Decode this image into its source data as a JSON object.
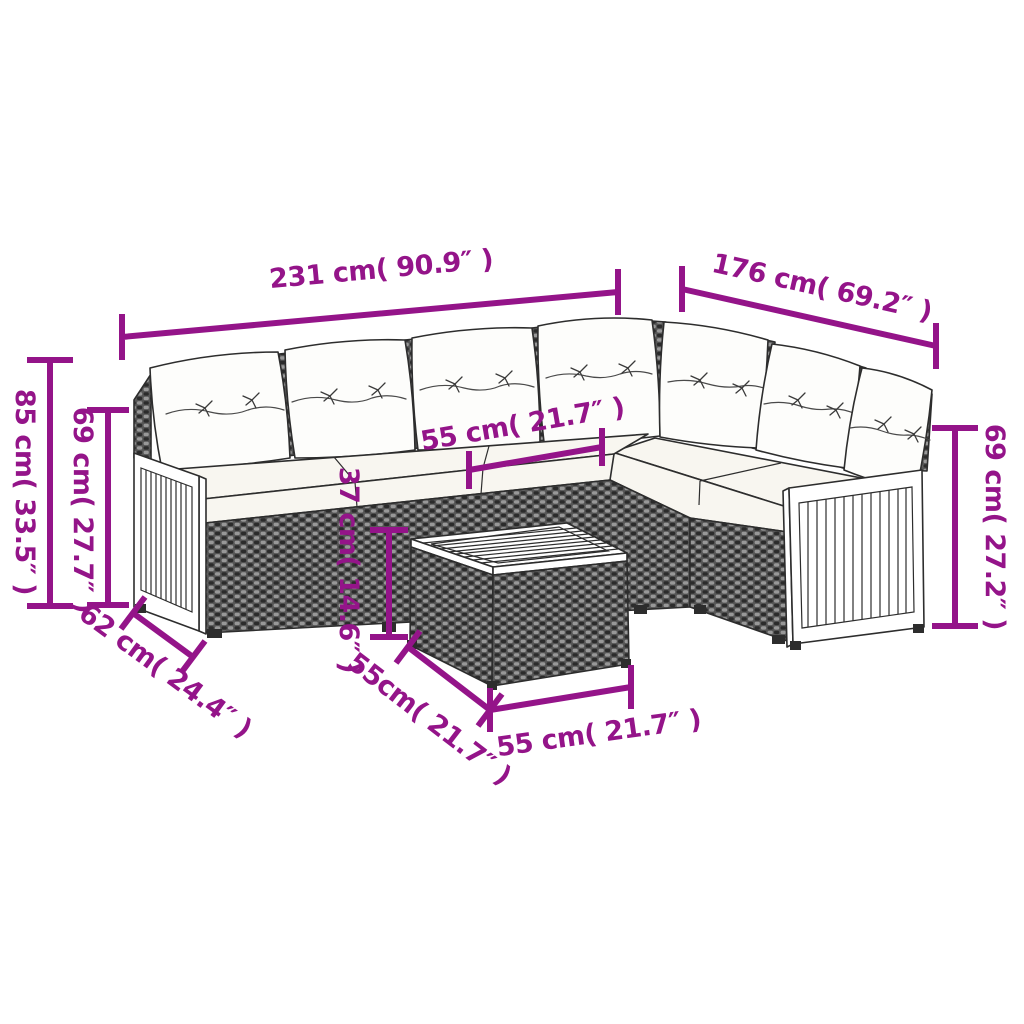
{
  "diagram": {
    "title": "Garden corner sofa set dimension diagram",
    "product": "Poly rattan corner sofa set with cushions and wooden coffee table",
    "style": {
      "dimension_color": "#941489",
      "outline_color": "#2d2d2d",
      "cushion_color": "#ffffff",
      "rattan_dark": "#2b2b2b",
      "rattan_light": "#989898"
    },
    "dimensions": {
      "sofa_left_length": "231 cm( 90.9″ )",
      "sofa_right_length": "176 cm( 69.2″ )",
      "total_height": "85 cm( 33.5″ )",
      "left_back_height": "69 cm( 27.7″ )",
      "right_back_height": "69 cm( 27.2″ )",
      "seat_width": "55 cm( 21.7″ )",
      "seat_height": "37 cm( 14.6″ )",
      "seat_depth": "62 cm( 24.4″ )",
      "table_depth": "55cm( 21.7″ )",
      "table_width": "55 cm( 21.7″ )"
    }
  }
}
